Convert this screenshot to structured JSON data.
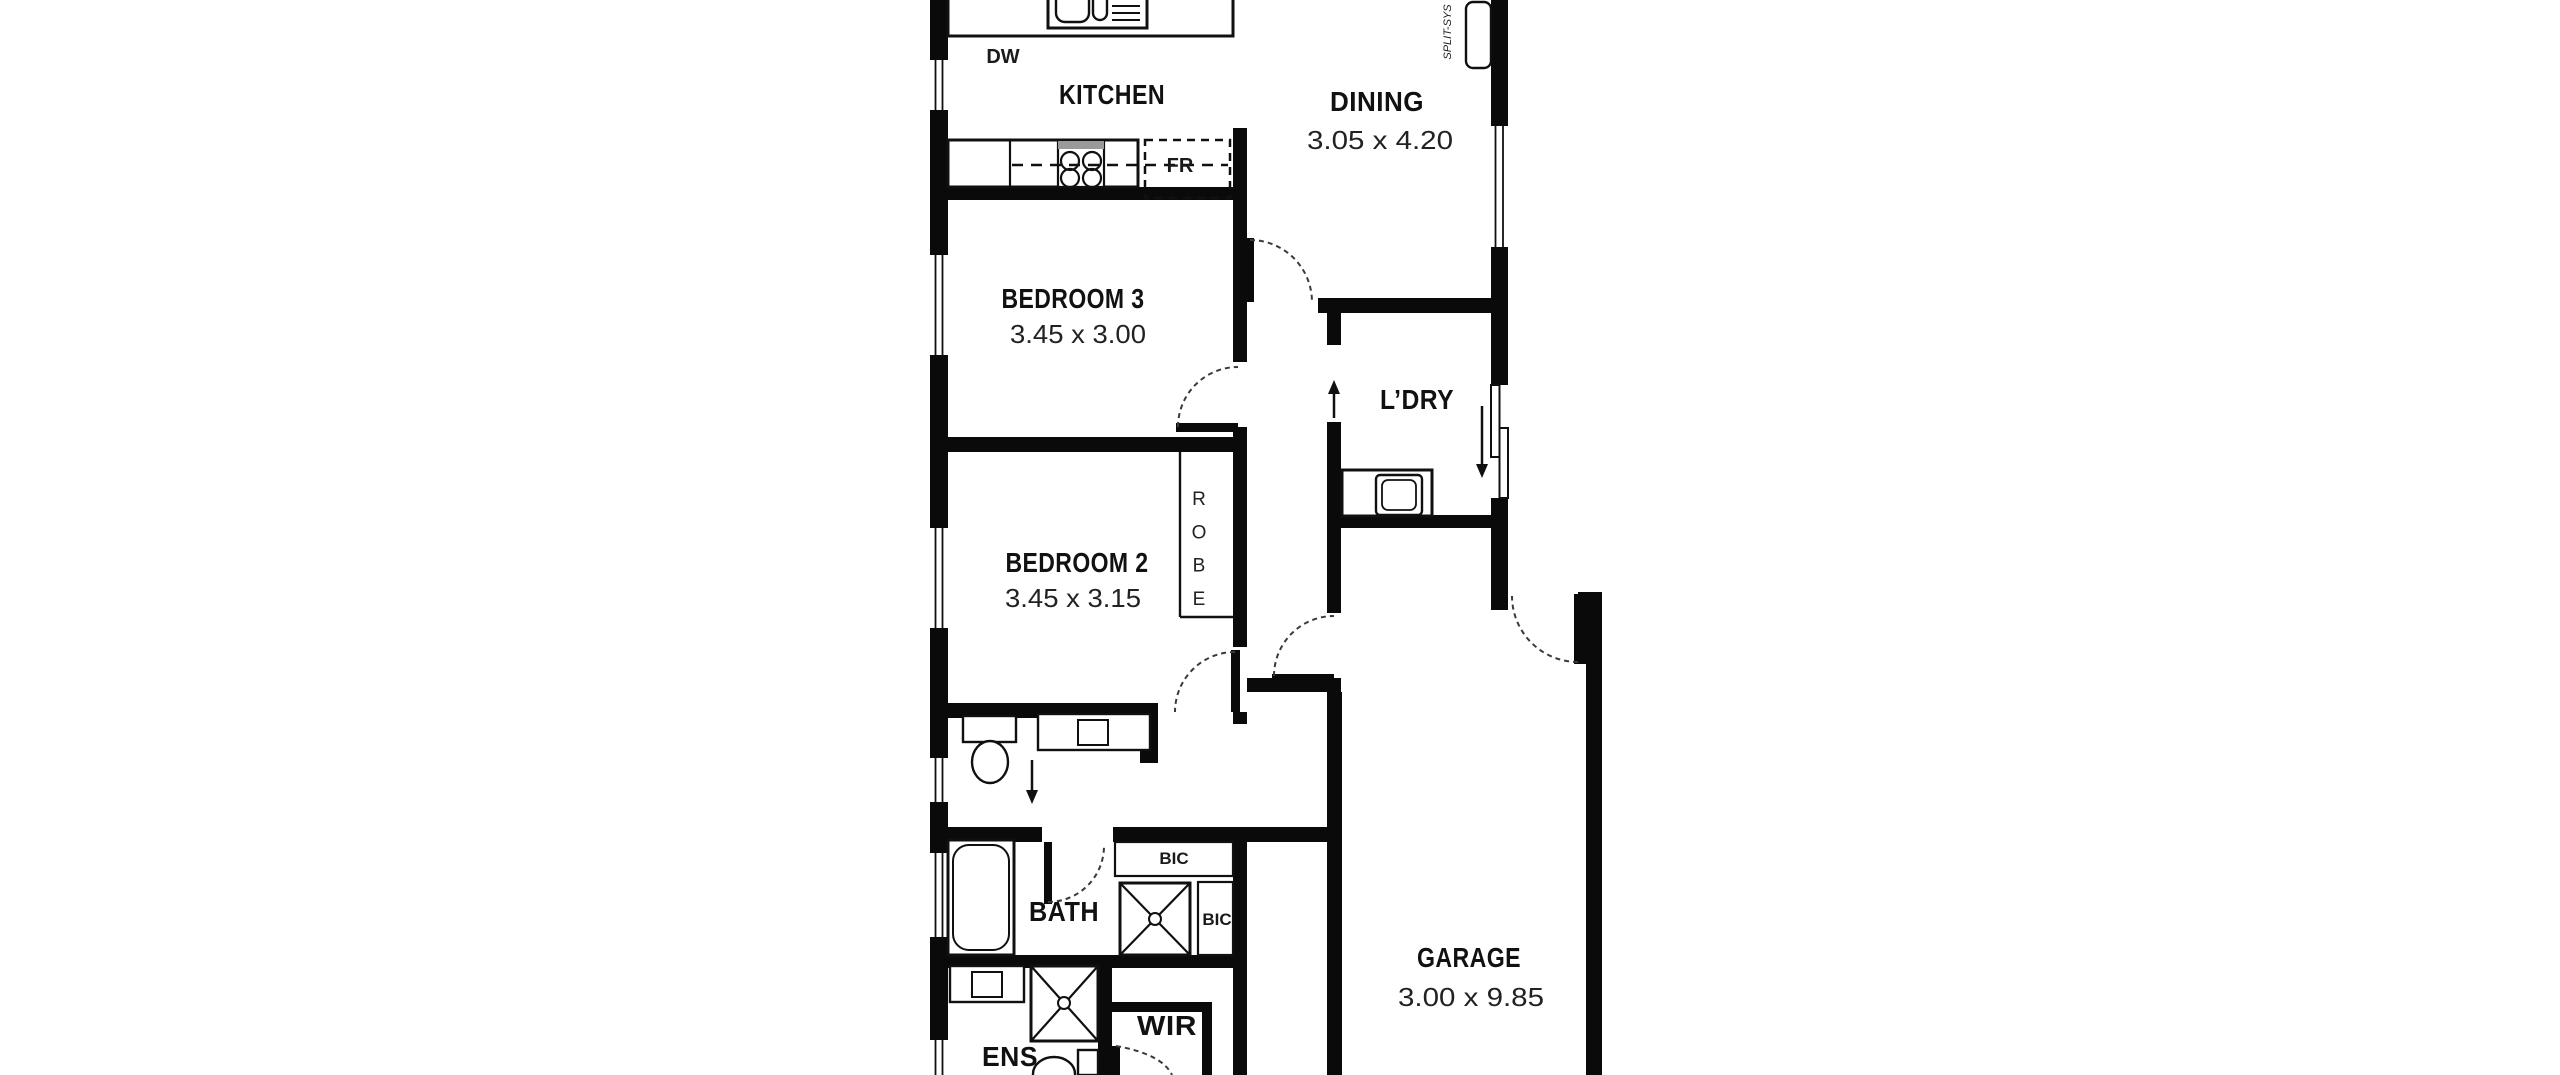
{
  "floorplan": {
    "title": "house-floor-plan",
    "colors": {
      "wall": "#0a0a0a",
      "background": "#ffffff",
      "appliance_gray": "#999999"
    },
    "rooms": {
      "kitchen": {
        "label": "KITCHEN"
      },
      "dining": {
        "label": "DINING",
        "dims": "3.05 x 4.20"
      },
      "bedroom3": {
        "label": "BEDROOM 3",
        "dims": "3.45 x 3.00"
      },
      "bedroom2": {
        "label": "BEDROOM 2",
        "dims": "3.45 x 3.15"
      },
      "laundry": {
        "label": "L’DRY"
      },
      "bath": {
        "label": "BATH"
      },
      "ens": {
        "label": "ENS"
      },
      "wir": {
        "label": "WIR"
      },
      "garage": {
        "label": "GARAGE",
        "dims": "3.00 x 9.85"
      }
    },
    "fixtures": {
      "dishwasher": "DW",
      "fridge": "FR",
      "robe": "ROBE",
      "bic_top": "BIC",
      "bic_side": "BIC",
      "split_system": "SPLIT-SYS"
    }
  }
}
